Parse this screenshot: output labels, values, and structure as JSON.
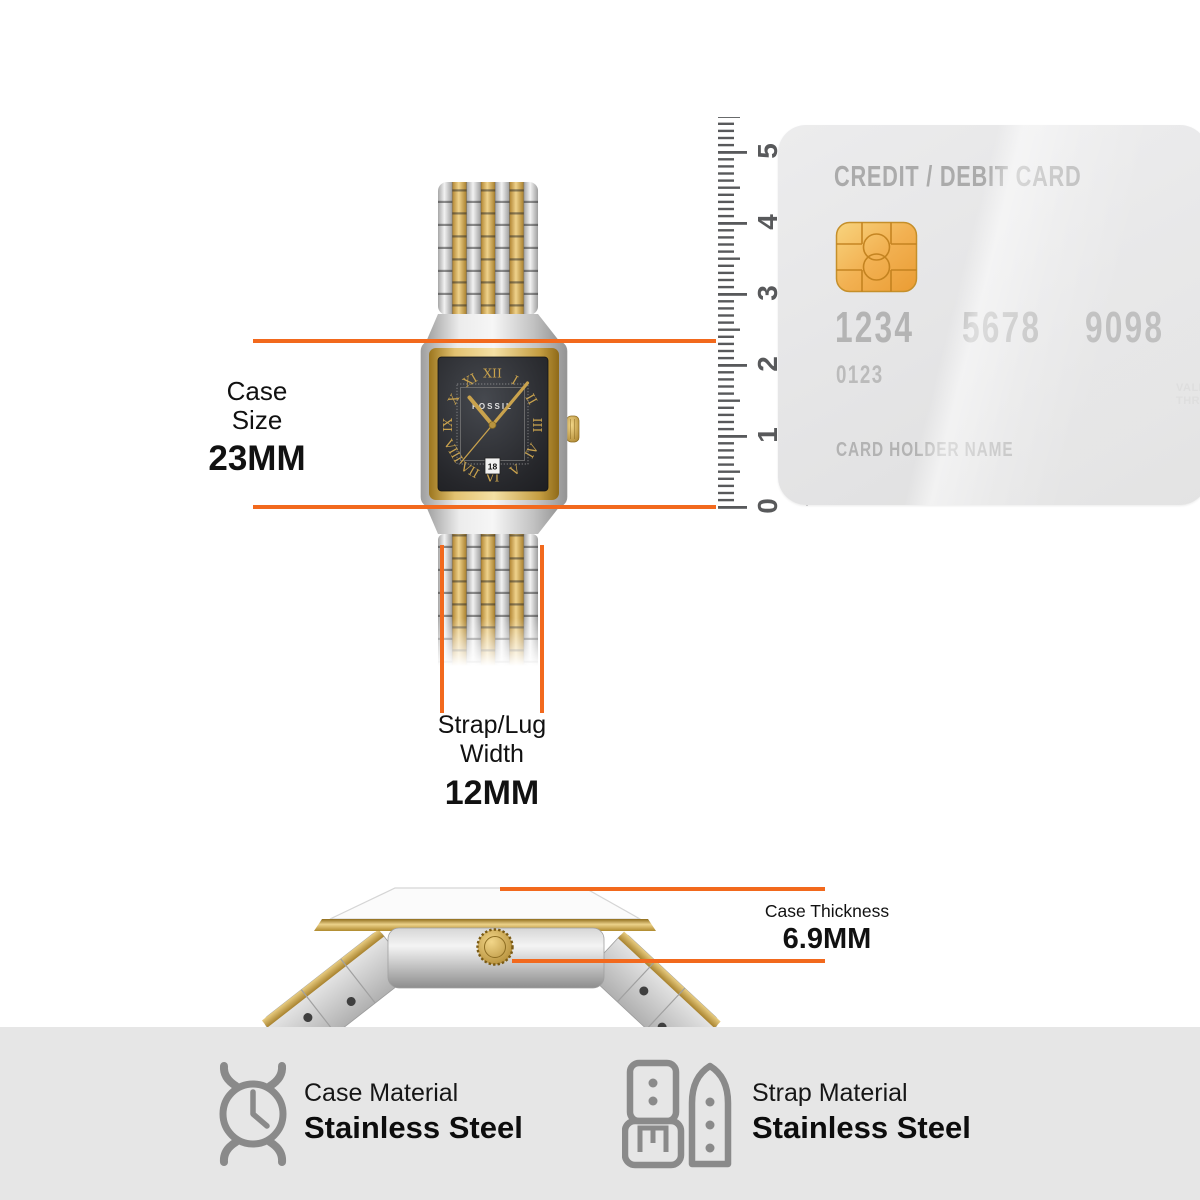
{
  "colors": {
    "accent-orange": "#F2691D",
    "ruler-gray": "#58595B",
    "card-text": "#B3B3B3",
    "chip-gold": "#EFAF4A",
    "footer-bg": "#E6E6E6",
    "icon-gray": "#8A8A8A",
    "label-black": "#111111",
    "watch-gold": "#C9A24D",
    "watch-silver": "#D9D9D9",
    "dial-black": "#26272B"
  },
  "measurements": {
    "case_size": {
      "label_line1": "Case",
      "label_line2": "Size",
      "value": "23MM"
    },
    "strap_width": {
      "label_line1": "Strap/Lug",
      "label_line2": "Width",
      "value": "12MM"
    },
    "case_thickness": {
      "label": "Case Thickness",
      "value": "6.9MM"
    }
  },
  "ruler": {
    "numbers": [
      "0",
      "1",
      "2",
      "3",
      "4",
      "5"
    ],
    "span_label": "54mm"
  },
  "card": {
    "title": "CREDIT / DEBIT CARD",
    "number_groups": [
      "1234",
      "5678",
      "9098"
    ],
    "account_number": "0123",
    "holder_label": "CARD HOLDER NAME",
    "valid_line1": "VALID",
    "valid_line2": "THRU"
  },
  "watch": {
    "brand": "FOSSIL",
    "date": "18",
    "numerals": [
      "XII",
      "I",
      "II",
      "III",
      "IV",
      "V",
      "VI",
      "VII",
      "VIII",
      "IX",
      "X",
      "XI"
    ]
  },
  "footer": {
    "case_material": {
      "label": "Case Material",
      "value": "Stainless Steel",
      "icon": "watch-case-icon"
    },
    "strap_material": {
      "label": "Strap Material",
      "value": "Stainless Steel",
      "icon": "strap-icon"
    }
  }
}
